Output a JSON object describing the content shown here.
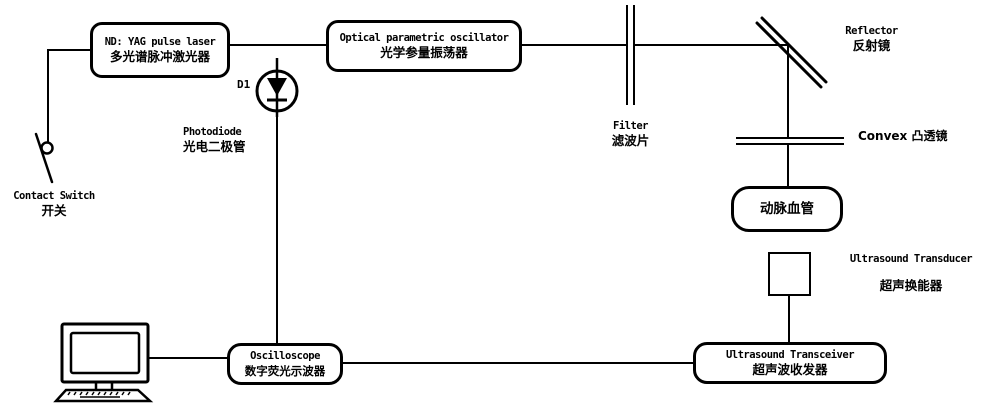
{
  "colors": {
    "line": "#000000",
    "background": "#ffffff",
    "text": "#000000"
  },
  "nodes": {
    "laser": {
      "en": "ND: YAG pulse laser",
      "zh": "多光谱脉冲激光器"
    },
    "opo": {
      "en": "Optical parametric oscillator",
      "zh": "光学参量振荡器"
    },
    "vessel": {
      "zh": "动脉血管"
    },
    "transceiver": {
      "en": "Ultrasound Transceiver",
      "zh": "超声波收发器"
    },
    "oscilloscope": {
      "en": "Oscilloscope",
      "zh": "数字荧光示波器"
    }
  },
  "labels": {
    "filter": {
      "en": "Filter",
      "zh": "滤波片"
    },
    "reflector": {
      "en": "Reflector",
      "zh": "反射镜"
    },
    "convex_lens": {
      "mixed": "Convex 凸透镜"
    },
    "transducer": {
      "en": "Ultrasound Transducer",
      "zh": "超声换能器"
    },
    "photodiode": {
      "en": "Photodiode",
      "zh": "光电二极管",
      "designator": "D1"
    },
    "contact_switch": {
      "en": "Contact Switch",
      "zh": "开关"
    }
  }
}
